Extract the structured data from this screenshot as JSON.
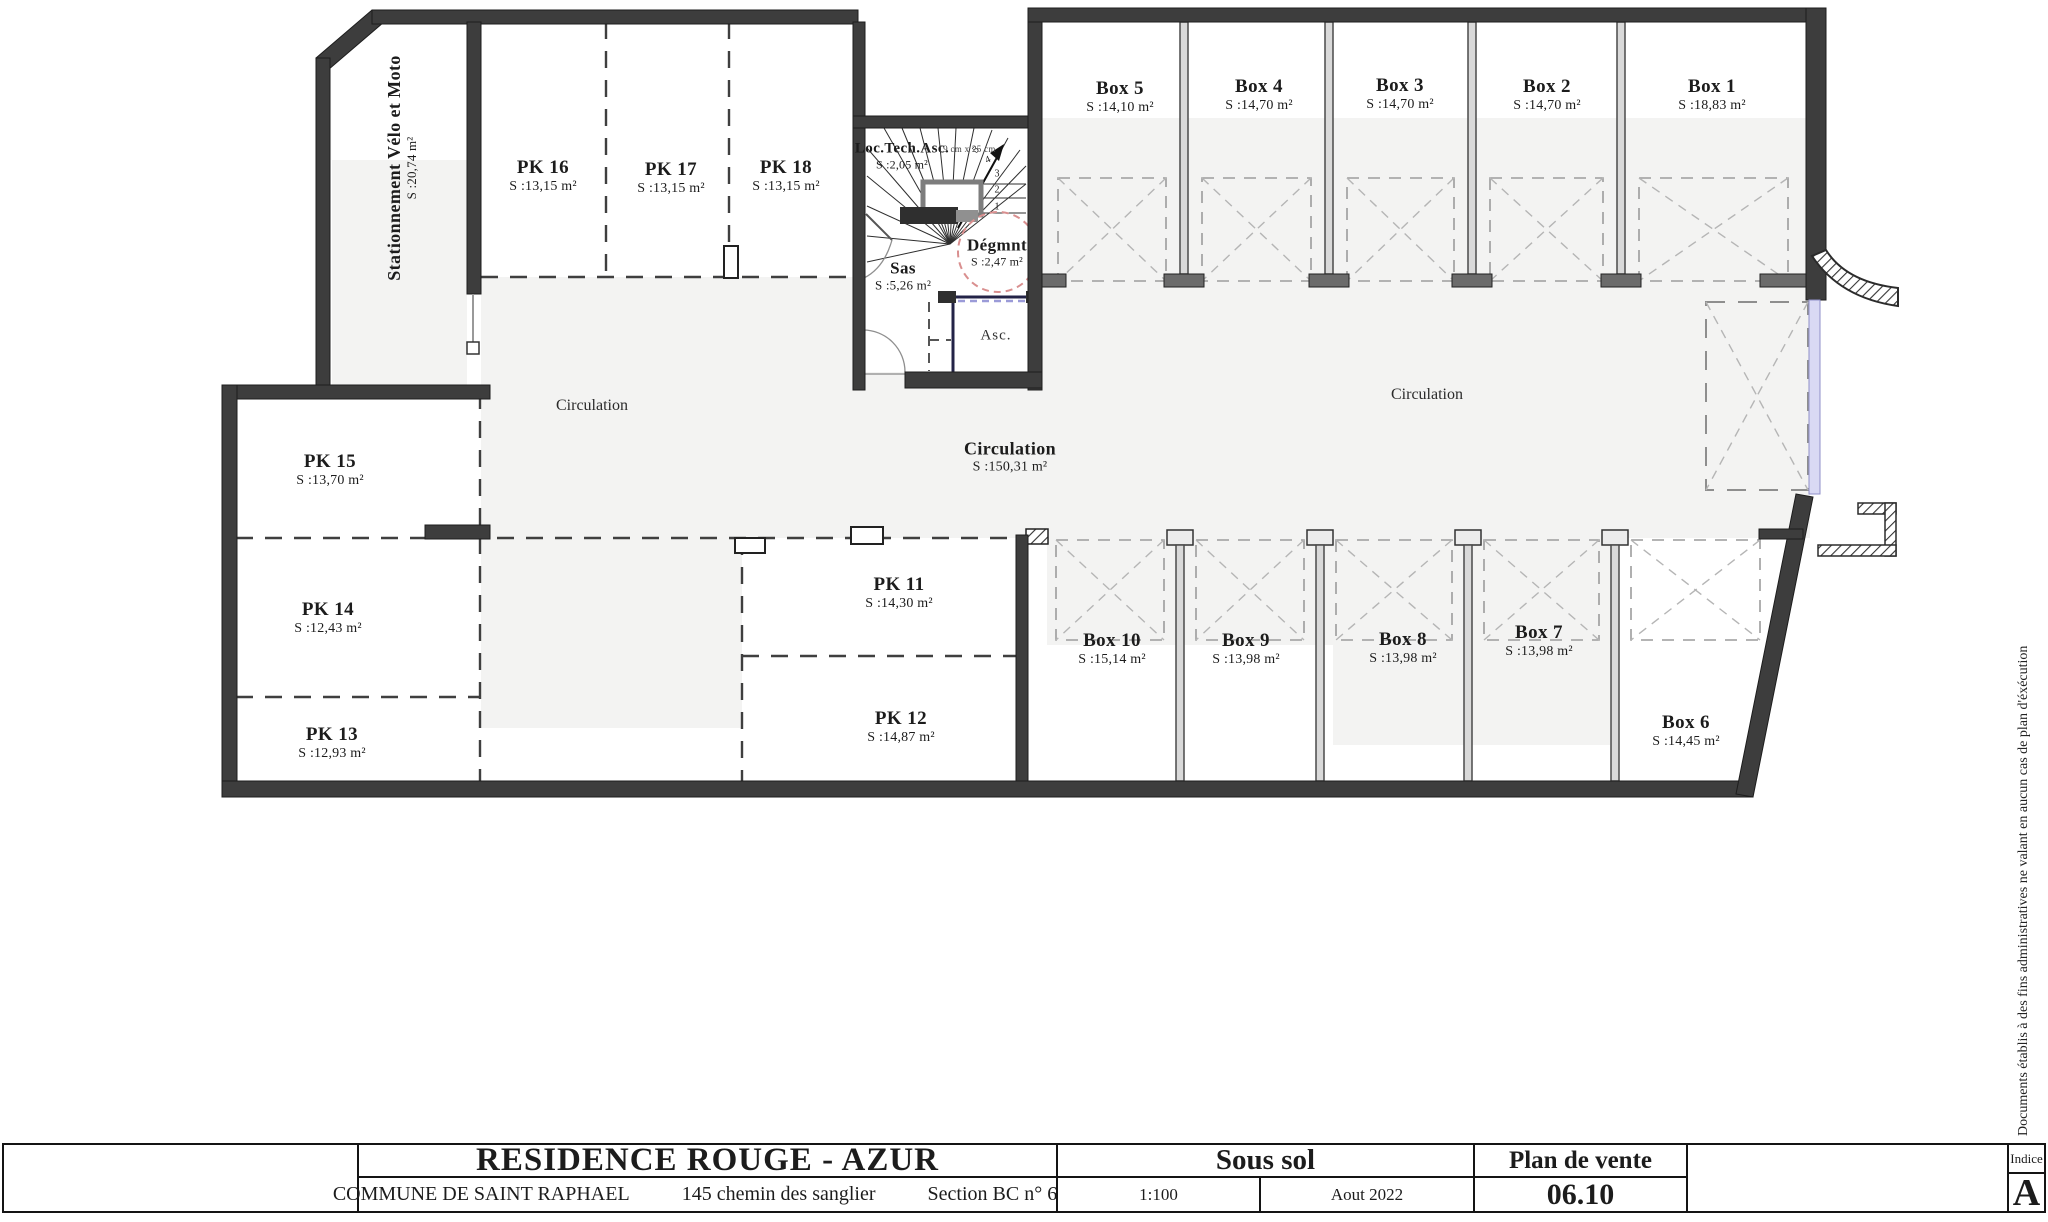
{
  "plan": {
    "rooms": {
      "velo": {
        "name": "Stationnement Vélo et Moto",
        "area": "S :20,74 m²"
      },
      "pk16": {
        "name": "PK 16",
        "area": "S :13,15 m²"
      },
      "pk17": {
        "name": "PK 17",
        "area": "S :13,15 m²"
      },
      "pk18": {
        "name": "PK 18",
        "area": "S :13,15 m²"
      },
      "loctech": {
        "name": "Loc.Tech.Asc.",
        "area": "S :2,05 m²"
      },
      "sas": {
        "name": "Sas",
        "area": "S :5,26 m²"
      },
      "degmnt": {
        "name": "Dégmnt",
        "area": "S :2,47 m²"
      },
      "asc": {
        "name": "Asc."
      },
      "box5": {
        "name": "Box 5",
        "area": "S :14,10 m²"
      },
      "box4": {
        "name": "Box 4",
        "area": "S :14,70 m²"
      },
      "box3": {
        "name": "Box 3",
        "area": "S :14,70 m²"
      },
      "box2": {
        "name": "Box 2",
        "area": "S :14,70 m²"
      },
      "box1": {
        "name": "Box 1",
        "area": "S :18,83 m²"
      },
      "circulation_left": {
        "name": "Circulation"
      },
      "circulation_right": {
        "name": "Circulation"
      },
      "circulation_main": {
        "name": "Circulation",
        "area": "S :150,31 m²"
      },
      "pk15": {
        "name": "PK 15",
        "area": "S :13,70 m²"
      },
      "pk14": {
        "name": "PK 14",
        "area": "S :12,43 m²"
      },
      "pk13": {
        "name": "PK 13",
        "area": "S :12,93 m²"
      },
      "pk11": {
        "name": "PK 11",
        "area": "S :14,30 m²"
      },
      "pk12": {
        "name": "PK 12",
        "area": "S :14,87 m²"
      },
      "box10": {
        "name": "Box  10",
        "area": "S :15,14 m²"
      },
      "box9": {
        "name": "Box 9",
        "area": "S :13,98 m²"
      },
      "box8": {
        "name": "Box 8",
        "area": "S :13,98 m²"
      },
      "box7": {
        "name": "Box 7",
        "area": "S :13,98 m²"
      },
      "box6": {
        "name": "Box 6",
        "area": "S :14,45 m²"
      }
    },
    "stair": {
      "dimension_note": "19 cm x 25 cm",
      "treads": [
        "1",
        "2",
        "3",
        "4",
        "5"
      ]
    }
  },
  "titleblock": {
    "project": "RESIDENCE  ROUGE - AZUR",
    "commune": "COMMUNE DE SAINT RAPHAEL",
    "address": "145 chemin des sanglier",
    "parcel": "Section  BC  n°  65 p",
    "level": "Sous sol",
    "scale": "1:100",
    "date": "Aout 2022",
    "document_type": "Plan de vente",
    "document_number": "06.10",
    "indice_label": "Indice",
    "indice_value": "A"
  },
  "side_note": "Documents établis à des fins administratives ne valant en aucun cas de plan d'éxécution",
  "colors": {
    "wall": "#3d3d3d",
    "floor_shade": "#f3f3f2",
    "degagement_circle": "#d98f8f",
    "garage_door": "#d9d9f4"
  }
}
